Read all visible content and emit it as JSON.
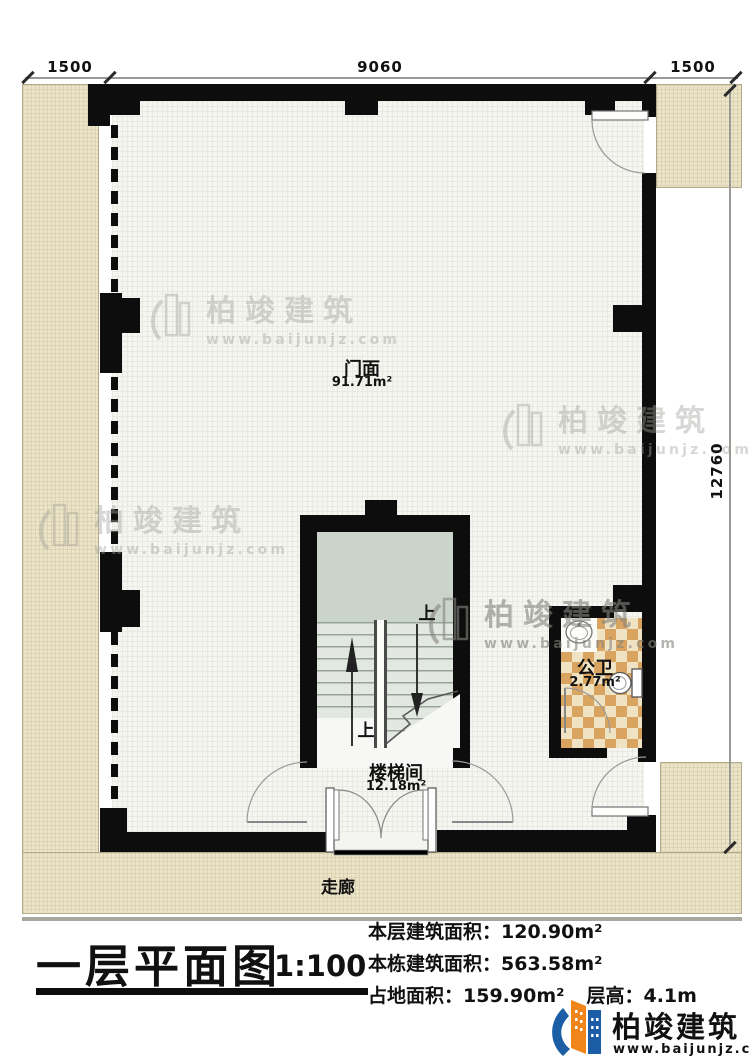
{
  "plan": {
    "dimensions": {
      "top_left": "1500",
      "top_mid": "9060",
      "top_right": "1500",
      "right_side": "12760"
    },
    "rooms": {
      "storefront": {
        "name": "门面",
        "area": "91.71m²"
      },
      "stairwell": {
        "name": "楼梯间",
        "area": "12.18m²"
      },
      "toilet": {
        "name": "公卫",
        "area": "2.77m²"
      },
      "corridor": {
        "name": "走廊"
      }
    },
    "stair_labels": {
      "up_top": "上",
      "up_bottom": "上"
    }
  },
  "title_block": {
    "title": "一层平面图",
    "scale": "1:100",
    "stats": [
      {
        "label": "本层建筑面积：",
        "value": "120.90m²"
      },
      {
        "label": "本栋建筑面积：",
        "value": "563.58m²"
      },
      {
        "label": "占地面积：",
        "value": "159.90m²",
        "label2": "层高：",
        "value2": "4.1m"
      }
    ]
  },
  "branding": {
    "company": "柏竣建筑",
    "website": "www.baijunjz.com"
  },
  "watermark": {
    "company": "柏竣建筑",
    "website": "www.baijunjz.com"
  },
  "colors": {
    "wall": "#0d0d0d",
    "exterior_paving": "#ede5ca",
    "stair_landing": "#cbd4ca",
    "tile_dark": "#d9a360",
    "tile_light": "#efe3c4",
    "brand_blue": "#1b5ea6",
    "brand_orange": "#f08519"
  }
}
